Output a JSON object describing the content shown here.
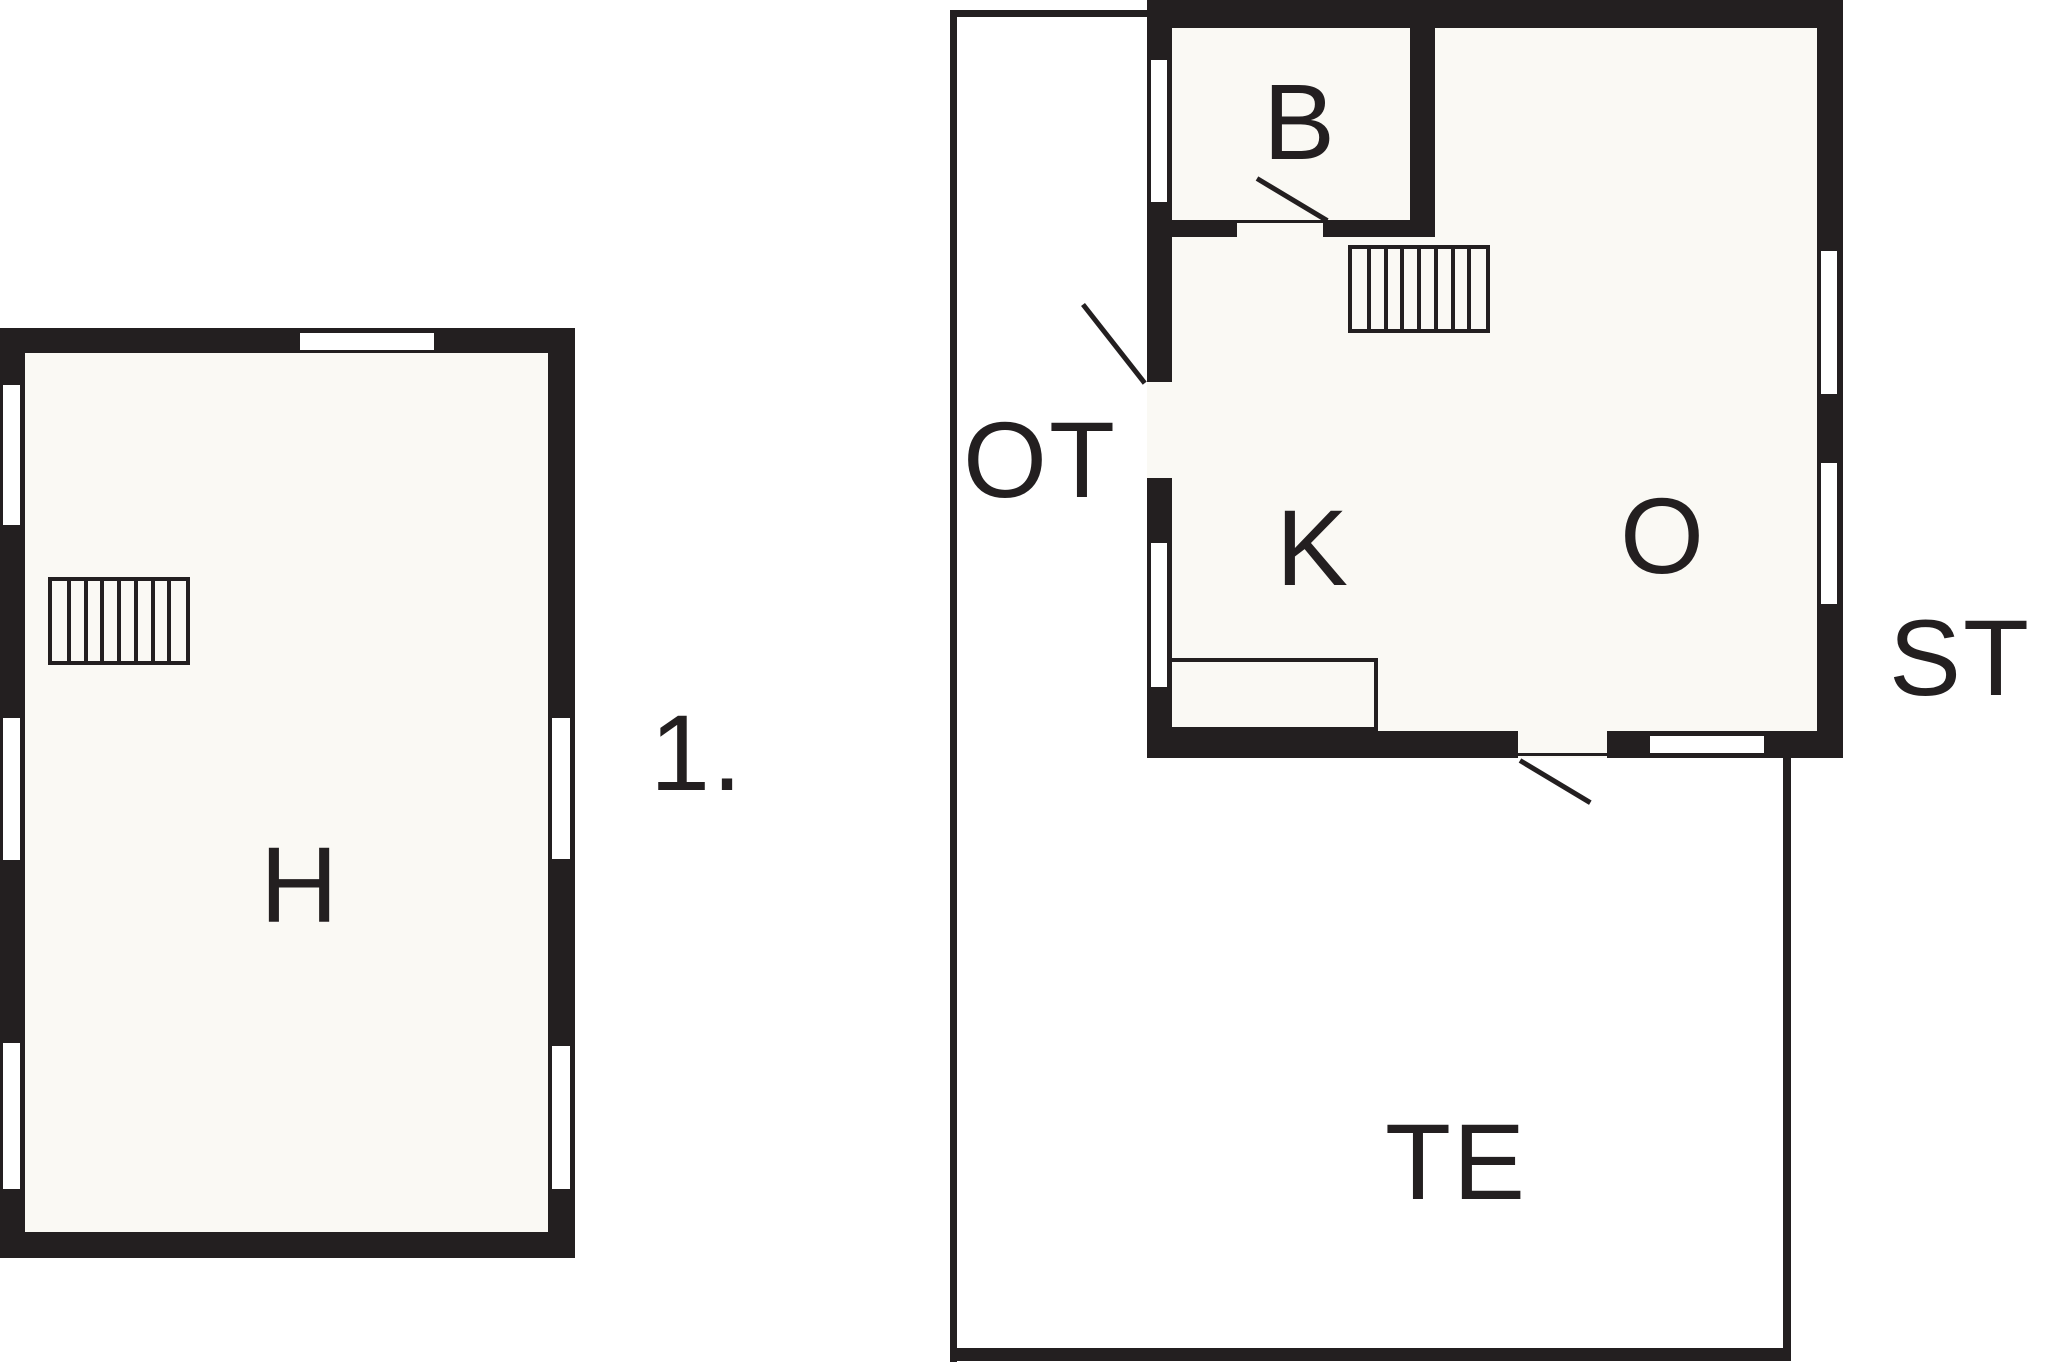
{
  "canvas": {
    "width": 2048,
    "height": 1365,
    "ink": "#231f20",
    "floor": "#faf9f4",
    "paper": "#ffffff"
  },
  "labels": [
    {
      "id": "room-label-h",
      "text": "H",
      "cx": 300,
      "cy": 885
    },
    {
      "id": "floor-number-label",
      "text": "1.",
      "cx": 697,
      "cy": 753
    },
    {
      "id": "room-label-b",
      "text": "B",
      "cx": 1300,
      "cy": 122
    },
    {
      "id": "room-label-k",
      "text": "K",
      "cx": 1313,
      "cy": 548
    },
    {
      "id": "room-label-o",
      "text": "O",
      "cx": 1663,
      "cy": 536
    },
    {
      "id": "terrace-label-ot",
      "text": "OT",
      "cx": 1040,
      "cy": 460
    },
    {
      "id": "label-st",
      "text": "ST",
      "cx": 1960,
      "cy": 658
    },
    {
      "id": "terrace-label-te",
      "text": "TE",
      "cx": 1456,
      "cy": 1162
    }
  ],
  "shapes": [
    {
      "id": "terrace-edge-top",
      "type": "thin",
      "x": 950,
      "y": 10,
      "w": 197,
      "h": 7
    },
    {
      "id": "terrace-edge-left",
      "type": "thin",
      "x": 950,
      "y": 10,
      "w": 7,
      "h": 1352
    },
    {
      "id": "terrace-edge-bottom",
      "type": "thin",
      "x": 950,
      "y": 1348,
      "w": 841,
      "h": 13
    },
    {
      "id": "terrace-edge-right",
      "type": "thin",
      "x": 1783,
      "y": 758,
      "w": 8,
      "h": 603
    },
    {
      "id": "house1-outer-walls",
      "type": "wall",
      "x": 0,
      "y": 328,
      "w": 575,
      "h": 930
    },
    {
      "id": "house1-floor",
      "type": "floor",
      "x": 25,
      "y": 353,
      "w": 523,
      "h": 879
    },
    {
      "id": "house2-outer-walls",
      "type": "wall",
      "x": 1147,
      "y": 0,
      "w": 696,
      "h": 758
    },
    {
      "id": "house2-floor",
      "type": "floor",
      "x": 1172,
      "y": 28,
      "w": 645,
      "h": 703
    },
    {
      "id": "room-b-right-wall",
      "type": "wall",
      "x": 1410,
      "y": 28,
      "w": 25,
      "h": 192
    },
    {
      "id": "room-b-bottom-wall-left",
      "type": "wall",
      "x": 1172,
      "y": 220,
      "w": 65,
      "h": 17
    },
    {
      "id": "room-b-bottom-wall-right",
      "type": "wall",
      "x": 1323,
      "y": 220,
      "w": 112,
      "h": 17
    },
    {
      "id": "entry-door-opening",
      "type": "gap",
      "x": 1147,
      "y": 382,
      "w": 25,
      "h": 96
    },
    {
      "id": "terrace-door-opening",
      "type": "gap",
      "x": 1518,
      "y": 731,
      "w": 89,
      "h": 27
    },
    {
      "id": "room-b-door-threshold",
      "type": "thin",
      "x": 1237,
      "y": 220,
      "w": 86,
      "h": 3
    },
    {
      "id": "terrace-door-threshold",
      "type": "thin",
      "x": 1518,
      "y": 753,
      "w": 89,
      "h": 3
    },
    {
      "id": "house1-window-top",
      "type": "window",
      "x": 297,
      "y": 330,
      "w": 140,
      "h": 23
    },
    {
      "id": "house1-window-left-1",
      "type": "window",
      "x": 0,
      "y": 382,
      "w": 23,
      "h": 146
    },
    {
      "id": "house1-window-left-2",
      "type": "window",
      "x": 0,
      "y": 715,
      "w": 23,
      "h": 148
    },
    {
      "id": "house1-window-left-3",
      "type": "window",
      "x": 0,
      "y": 1040,
      "w": 23,
      "h": 152
    },
    {
      "id": "house1-window-right-1",
      "type": "window",
      "x": 549,
      "y": 715,
      "w": 24,
      "h": 147
    },
    {
      "id": "house1-window-right-2",
      "type": "window",
      "x": 549,
      "y": 1043,
      "w": 24,
      "h": 149
    },
    {
      "id": "house2-window-left-1",
      "type": "window",
      "x": 1148,
      "y": 57,
      "w": 22,
      "h": 148
    },
    {
      "id": "house2-window-left-2",
      "type": "window",
      "x": 1148,
      "y": 540,
      "w": 22,
      "h": 150
    },
    {
      "id": "house2-window-right-1",
      "type": "window",
      "x": 1818,
      "y": 248,
      "w": 22,
      "h": 149
    },
    {
      "id": "house2-window-right-2",
      "type": "window",
      "x": 1818,
      "y": 460,
      "w": 22,
      "h": 147
    },
    {
      "id": "house2-window-bottom",
      "type": "window",
      "x": 1647,
      "y": 733,
      "w": 120,
      "h": 23
    },
    {
      "id": "house1-stairs",
      "type": "stairs",
      "x": 48,
      "y": 577,
      "w": 142,
      "h": 88,
      "columns": 8
    },
    {
      "id": "house2-stairs",
      "type": "stairs",
      "x": 1348,
      "y": 245,
      "w": 142,
      "h": 88,
      "columns": 8
    },
    {
      "id": "kitchen-counter",
      "type": "counter",
      "x": 1168,
      "y": 658,
      "w": 210,
      "h": 73
    },
    {
      "id": "room-b-door-swing",
      "type": "line",
      "x1": 1257,
      "y1": 178,
      "x2": 1327,
      "y2": 220,
      "w": 5
    },
    {
      "id": "entry-door-swing",
      "type": "line",
      "x1": 1083,
      "y1": 304,
      "x2": 1145,
      "y2": 383,
      "w": 5
    },
    {
      "id": "terrace-door-swing",
      "type": "line",
      "x1": 1520,
      "y1": 760,
      "x2": 1590,
      "y2": 802,
      "w": 5
    }
  ]
}
